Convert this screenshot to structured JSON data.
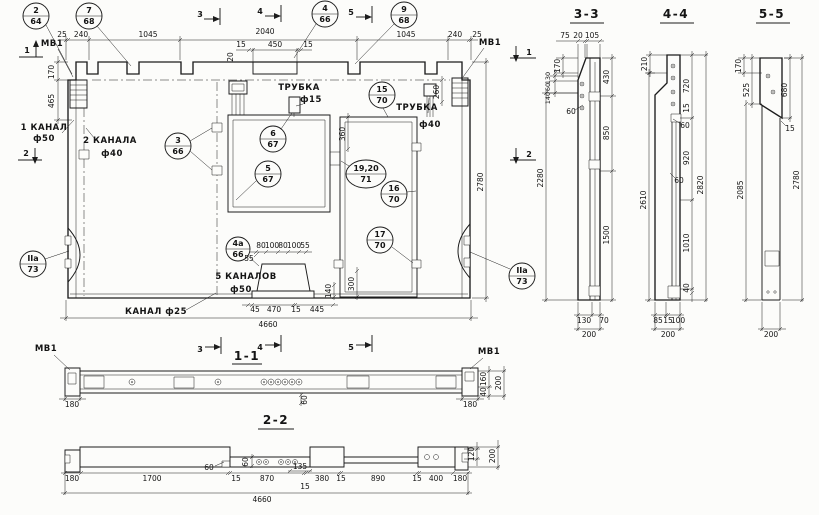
{
  "callouts": [
    {
      "num": "2",
      "sheet": "64"
    },
    {
      "num": "7",
      "sheet": "68"
    },
    {
      "num": "4",
      "sheet": "66"
    },
    {
      "num": "9",
      "sheet": "68"
    },
    {
      "num": "3",
      "sheet": "66"
    },
    {
      "num": "6",
      "sheet": "67"
    },
    {
      "num": "5",
      "sheet": "67"
    },
    {
      "num": "15",
      "sheet": "70"
    },
    {
      "num": "19,20",
      "sheet": "71"
    },
    {
      "num": "16",
      "sheet": "70"
    },
    {
      "num": "17",
      "sheet": "70"
    },
    {
      "num": "4а",
      "sheet": "66"
    },
    {
      "num": "IIа",
      "sheet": "73"
    },
    {
      "num": "IIа",
      "sheet": "73"
    }
  ],
  "marks": {
    "m1": "1",
    "m2": "2",
    "m3": "3",
    "m4": "4",
    "m5": "5"
  },
  "view_titles": {
    "v11": "1-1",
    "v22": "2-2",
    "v33": "3-3",
    "v44": "4-4",
    "v55": "5-5"
  },
  "labels": {
    "mv1": "МВ1",
    "canal1_l1": "1 КАНАЛ",
    "canal1_l2": "ф50",
    "canal2_l1": "2 КАНАЛА",
    "canal2_l2": "ф40",
    "tube15_l1": "ТРУБКА",
    "tube15_l2": "ф15",
    "tube40_l1": "ТРУБКА",
    "tube40_l2": "ф40",
    "canal25": "КАНАЛ ф25",
    "canal5_l1": "5 КАНАЛОВ",
    "canal5_l2": "ф50"
  },
  "plan": {
    "dims_top": [
      "25",
      "240",
      "1045",
      "2040",
      "1045",
      "240",
      "25"
    ],
    "dims_rib": [
      "15",
      "450",
      "15"
    ],
    "dim_rib_v": "20",
    "dims_left": [
      "170",
      "465"
    ],
    "dim_height": "2780",
    "dim_260": "260",
    "dims_window": [
      "360",
      "300",
      "140"
    ],
    "dims_bottom": [
      "45",
      "470",
      "15",
      "445"
    ],
    "dims_channels": [
      "80",
      "100",
      "80",
      "100",
      "55"
    ],
    "dim_channels_lead": "55",
    "dim_total": "4660"
  },
  "s11": {
    "dim_left": "180",
    "dim_right": "180",
    "dim_mid": "60",
    "dims_right": [
      "160",
      "200",
      "40"
    ]
  },
  "s22": {
    "dims_bottom": [
      "180",
      "1700",
      "15",
      "870",
      "380",
      "15",
      "890",
      "15",
      "400",
      "180"
    ],
    "dims_detail": [
      "60",
      "60",
      "135",
      "15"
    ],
    "dims_right": [
      "120",
      "200"
    ],
    "dim_total": "4660"
  },
  "s33": {
    "dims_top": [
      "75",
      "20",
      "105"
    ],
    "dims_left": [
      "170",
      "130",
      "60",
      "140"
    ],
    "dim_lead": "60",
    "dim_height": "2280",
    "dims_right": [
      "430",
      "850",
      "1500"
    ],
    "dims_bottom": [
      "130",
      "70"
    ],
    "dim_width": "200"
  },
  "s44": {
    "dim_top": "210",
    "dims_right": [
      "720",
      "15",
      "920",
      "2820",
      "1010",
      "40"
    ],
    "dims_lead": [
      "60",
      "60"
    ],
    "dim_height": "2610",
    "dims_bottom": [
      "85",
      "15",
      "100"
    ],
    "dim_width": "200"
  },
  "s55": {
    "dims_left": [
      "170",
      "525",
      "2085"
    ],
    "dims_right": [
      "680",
      "2780"
    ],
    "dim_lead": "15",
    "dim_width": "200"
  }
}
